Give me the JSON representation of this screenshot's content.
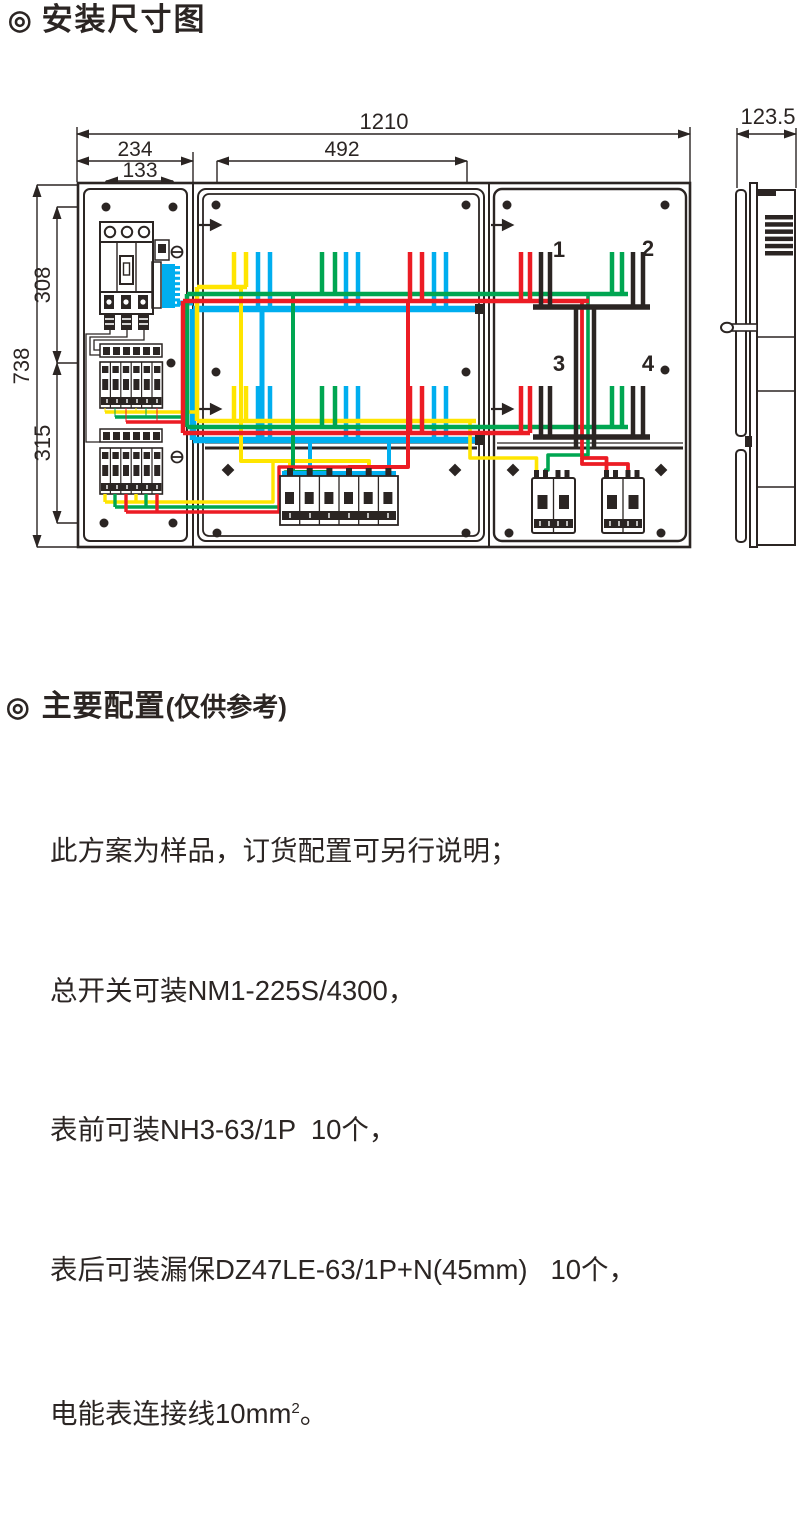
{
  "page": {
    "bullet": "◎",
    "title": "安装尺寸图"
  },
  "front_view": {
    "dim_overall_width": "1210",
    "dim_left_section_width": "234",
    "dim_left_hole_spacing": "133",
    "dim_middle_hole_spacing": "492",
    "dim_overall_height": "738",
    "dim_upper_hole_offset": "308",
    "dim_lower_hole_offset": "315",
    "meter_positions": [
      "1",
      "2",
      "3",
      "4"
    ]
  },
  "side_view": {
    "dim_depth": "123.5"
  },
  "wire_colors": {
    "phase_yellow": "#ffe500",
    "phase_green": "#00a651",
    "phase_red": "#ec1c24",
    "neutral_blue": "#00aeef",
    "meter_black": "#2b2523"
  },
  "config": {
    "bullet": "◎",
    "title": "主要配置",
    "subtitle": "(仅供参考)",
    "lines": [
      "此方案为样品，订货配置可另行说明；",
      "总开关可装NM1-225S/4300，",
      "表前可装NH3-63/1P  10个，",
      "表后可装漏保DZ47LE-63/1P+N(45mm)   10个，"
    ],
    "line5_main": "电能表连接线10mm",
    "line5_sup": "2",
    "line5_end": "。"
  }
}
